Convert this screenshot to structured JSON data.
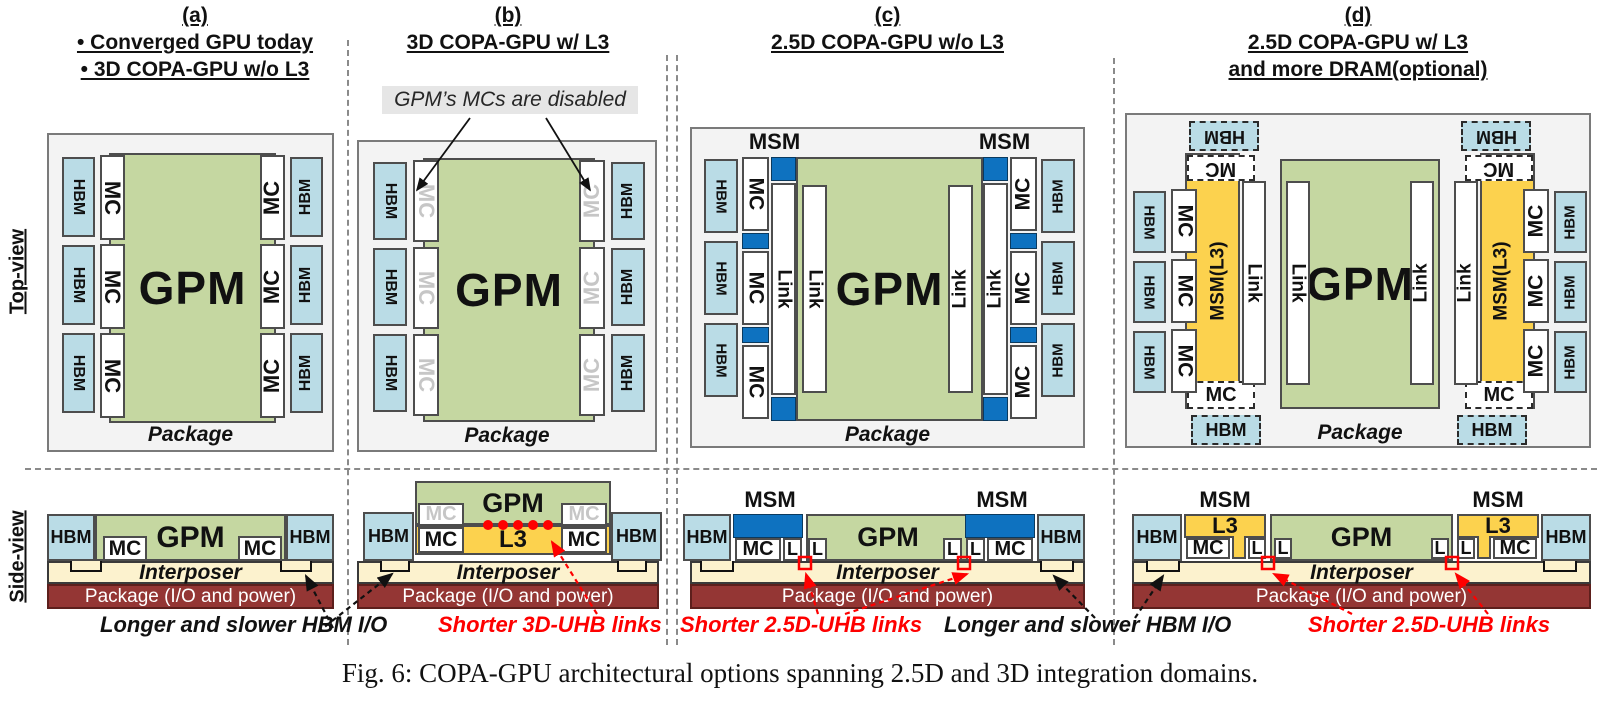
{
  "figure_caption": "Fig. 6: COPA-GPU architectural options spanning 2.5D and 3D integration domains.",
  "row_labels": {
    "top": "Top-view",
    "side": "Side-view"
  },
  "blocks": {
    "hbm": "HBM",
    "mc": "MC",
    "gpm": "GPM",
    "link": "Link",
    "msm": "MSM",
    "msm_l3": "MSM(L3)",
    "l3": "L3",
    "l": "L",
    "package": "Package",
    "interposer": "Interposer",
    "package_io": "Package (I/O and  power)"
  },
  "panels": [
    {
      "id": "a",
      "tag": "(a)",
      "lines": [
        "• Converged GPU today",
        "• 3D COPA-GPU w/o L3"
      ]
    },
    {
      "id": "b",
      "tag": "(b)",
      "lines": [
        "3D COPA-GPU w/ L3"
      ],
      "note": "GPM’s MCs are disabled"
    },
    {
      "id": "c",
      "tag": "(c)",
      "lines": [
        "2.5D COPA-GPU w/o L3"
      ]
    },
    {
      "id": "d",
      "tag": "(d)",
      "lines": [
        "2.5D COPA-GPU  w/ L3",
        "and more DRAM(optional)"
      ]
    }
  ],
  "annotations": {
    "hbm_io_left": "Longer and slower HBM I/O",
    "uhb_3d": "Shorter 3D-UHB links",
    "uhb_25d_c": "Shorter 2.5D-UHB links",
    "hbm_io_right": "Longer and slower HBM I/O",
    "uhb_25d_d": "Shorter 2.5D-UHB links"
  },
  "colors": {
    "gpm_green": "#c5d7a1",
    "hbm_blue": "#badce6",
    "msm_blue": "#0e72c0",
    "l3_yellow": "#fcd24e",
    "interposer_cream": "#fcf2ce",
    "package_red": "#943634",
    "package_gray": "#f3f3f3",
    "annotation_red": "#fe0000",
    "disabled_gray": "#c6c6c6"
  }
}
